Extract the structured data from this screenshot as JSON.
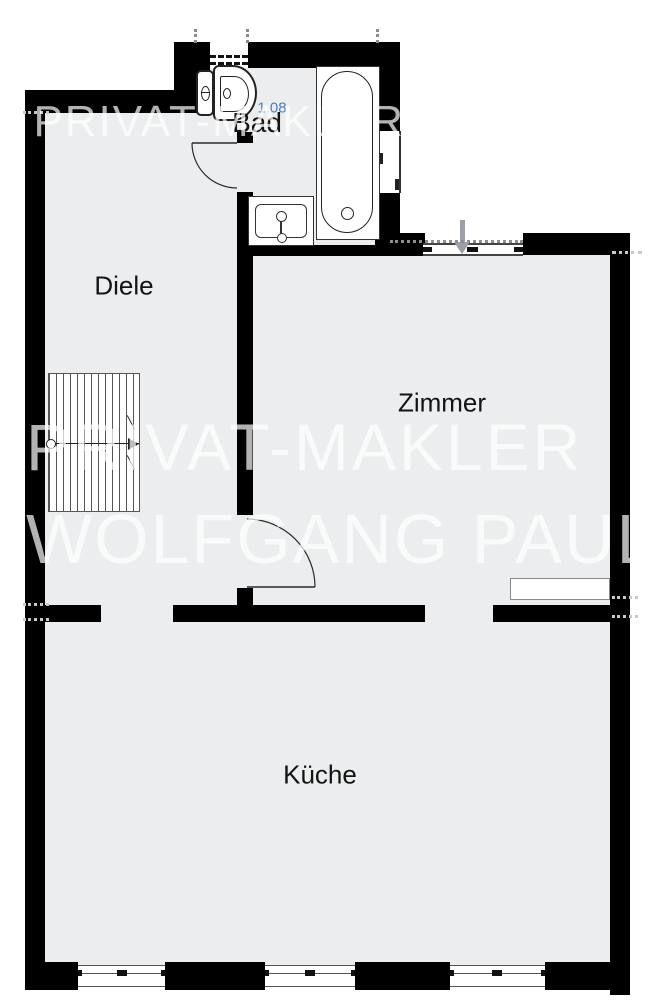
{
  "floorplan": {
    "rooms": [
      {
        "id": "bad",
        "label": "Bad"
      },
      {
        "id": "diele",
        "label": "Diele"
      },
      {
        "id": "zimmer",
        "label": "Zimmer"
      },
      {
        "id": "kueche",
        "label": "Küche"
      }
    ],
    "measurements": {
      "bad_blue": "1.08"
    },
    "watermark": {
      "top_partial": "PRIVAT-MAKLER",
      "line1": "PRIVAT-MAKLER",
      "line2": "WOLFGANG PAULY"
    },
    "fixtures": [
      "toilet",
      "sink",
      "bathtub",
      "stairs",
      "entrance-arrow",
      "sideboard"
    ],
    "colors": {
      "floor": "#ebedee",
      "wall": "#000000",
      "line": "#2b2b2b",
      "measurement_blue": "#4b80c8",
      "watermark": "rgba(255,255,255,0.70)",
      "arrow": "#9aa0a6"
    }
  }
}
